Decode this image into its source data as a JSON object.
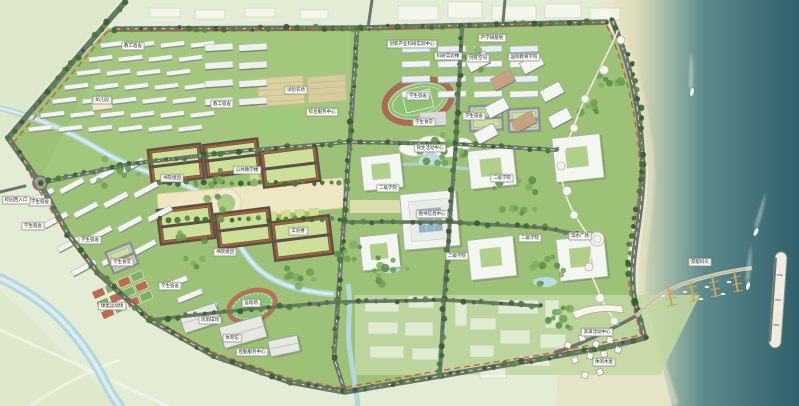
{
  "map": {
    "labels": [
      {
        "text": "教工宿舍",
        "x": 133,
        "y": 46
      },
      {
        "text": "教工宿舍",
        "x": 222,
        "y": 104
      },
      {
        "text": "幼儿园",
        "x": 102,
        "y": 100
      },
      {
        "text": "试验农场",
        "x": 296,
        "y": 90
      },
      {
        "text": "综合服务中心",
        "x": 322,
        "y": 112
      },
      {
        "text": "创新产业科研实验中心",
        "x": 412,
        "y": 44
      },
      {
        "text": "科研实验楼",
        "x": 448,
        "y": 56
      },
      {
        "text": "产学研基地",
        "x": 492,
        "y": 38
      },
      {
        "text": "创客空间",
        "x": 478,
        "y": 58
      },
      {
        "text": "国际教育学院",
        "x": 524,
        "y": 57
      },
      {
        "text": "学生宿舍",
        "x": 418,
        "y": 96
      },
      {
        "text": "学生宿舍",
        "x": 474,
        "y": 116
      },
      {
        "text": "学生食堂",
        "x": 424,
        "y": 122
      },
      {
        "text": "师生活动中心",
        "x": 430,
        "y": 148
      },
      {
        "text": "公共教学楼",
        "x": 247,
        "y": 170
      },
      {
        "text": "书院组团",
        "x": 172,
        "y": 178
      },
      {
        "text": "书院组团",
        "x": 225,
        "y": 252
      },
      {
        "text": "实验楼",
        "x": 298,
        "y": 231
      },
      {
        "text": "图书信息中心",
        "x": 432,
        "y": 214
      },
      {
        "text": "二级学院",
        "x": 388,
        "y": 188
      },
      {
        "text": "二级学院",
        "x": 502,
        "y": 178
      },
      {
        "text": "二级学院",
        "x": 457,
        "y": 256
      },
      {
        "text": "二级学院",
        "x": 530,
        "y": 238
      },
      {
        "text": "学生宿舍",
        "x": 40,
        "y": 202
      },
      {
        "text": "学生宿舍",
        "x": 33,
        "y": 226
      },
      {
        "text": "学生宿舍",
        "x": 90,
        "y": 240
      },
      {
        "text": "学生食堂",
        "x": 122,
        "y": 262
      },
      {
        "text": "校园西入口",
        "x": 16,
        "y": 200
      },
      {
        "text": "球类运动场",
        "x": 112,
        "y": 306
      },
      {
        "text": "学生宿舍",
        "x": 170,
        "y": 286
      },
      {
        "text": "风雨操场",
        "x": 210,
        "y": 320
      },
      {
        "text": "体育馆",
        "x": 232,
        "y": 338
      },
      {
        "text": "后勤服务中心",
        "x": 252,
        "y": 352
      },
      {
        "text": "运动场",
        "x": 251,
        "y": 303
      },
      {
        "text": "滨水广场",
        "x": 580,
        "y": 236
      },
      {
        "text": "滨海活动中心",
        "x": 597,
        "y": 332
      },
      {
        "text": "休闲木屋",
        "x": 604,
        "y": 362
      },
      {
        "text": "游艇码头",
        "x": 700,
        "y": 262
      }
    ],
    "colors": {
      "field_background": "#e3ecd4",
      "campus_green": "#9cc177",
      "road_gray": "#6f746f",
      "boundary_red": "#d64430",
      "river_blue": "#b5d6de",
      "sea_deep": "#30606c",
      "beach_sand": "#ece9cc",
      "courtyard_roof": "#a06338",
      "track_surface": "#a96b54",
      "building_white": "#f4f6f2",
      "library_glass_roof": "#8fb5c4",
      "dock_timber": "#c8a65e"
    },
    "water_features": {
      "sea_boats": 3,
      "marina_finger_docks": 4,
      "marina_moored_boats": 6,
      "breakwater": 1
    }
  }
}
